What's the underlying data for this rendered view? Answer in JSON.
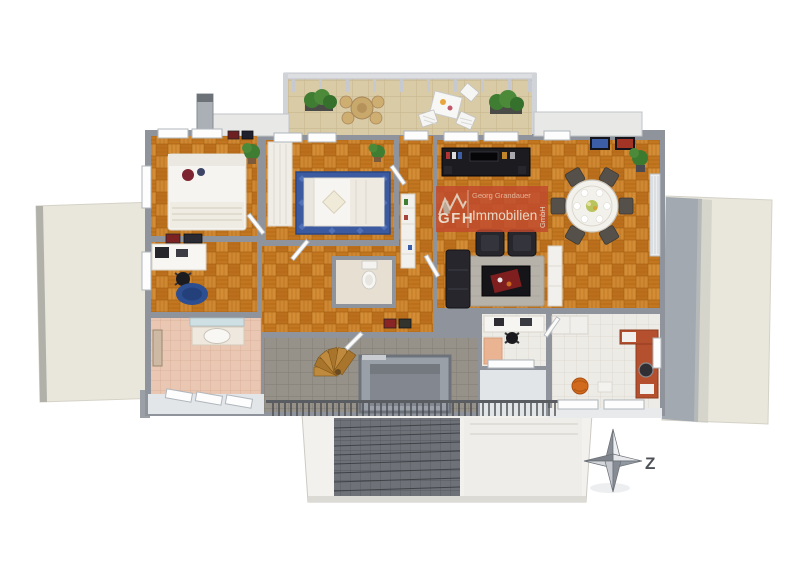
{
  "watermark": {
    "owner_line": "Georg Grandauer",
    "brand": "GFH",
    "brand_suffix": "Immobilien",
    "legal_suffix": "GmbH"
  },
  "compass": {
    "label": "Z"
  },
  "colors": {
    "watermark_red": "#c14a2e",
    "parquet_base": "#c87c22",
    "wall_gray": "#8f949c",
    "roof_cream": "#e9e6db",
    "balcony_tile": "#d9cba6",
    "bedroom_rug_blue": "#3b5aa0",
    "office_rug_blue": "#2d4e90",
    "sofa_black": "#26262c",
    "counter_terracotta": "#b5502e",
    "plant_green": "#3e7d32"
  }
}
